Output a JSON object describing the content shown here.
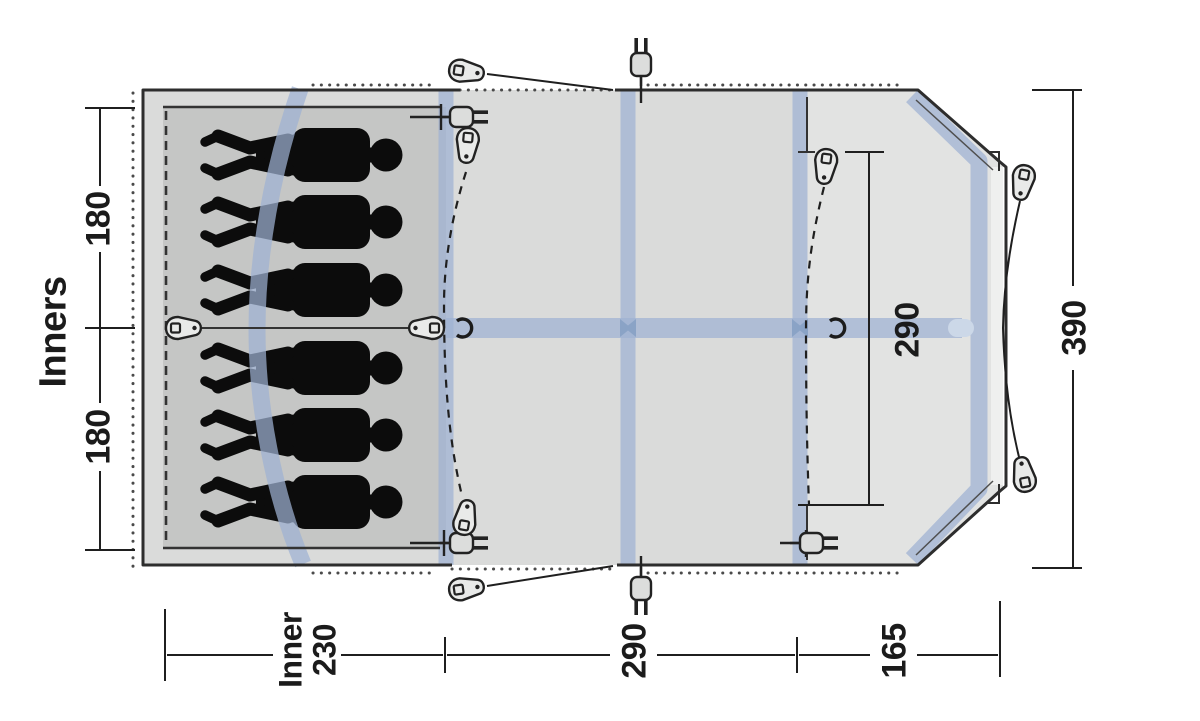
{
  "labels": {
    "inners": "Inners",
    "inner_depth_top": "180",
    "inner_depth_bottom": "180",
    "total_depth": "390",
    "porch_clear_height": "290",
    "bottom_inner_word": "Inner",
    "bottom_inner_width": "230",
    "bottom_living_width": "290",
    "bottom_porch_width": "165"
  },
  "figures": {
    "sleeper_count": 6
  },
  "icons": [
    "tent-peg-icon",
    "zipper-pull-icon",
    "power-inlet-icon",
    "tieback-hook-icon"
  ],
  "colors": {
    "background": "#ffffff",
    "living_area": "#dadbda",
    "inner_area": "#c5c6c5",
    "porch_area": "#e2e3e2",
    "front_strip": "#eff0ef",
    "pole_band": "#9eb2d2",
    "pole_band_dark": "#8aa3c6",
    "outline": "#2d2d2d",
    "silhouette": "#0c0c0c",
    "dimension": "#1f1f1f"
  }
}
